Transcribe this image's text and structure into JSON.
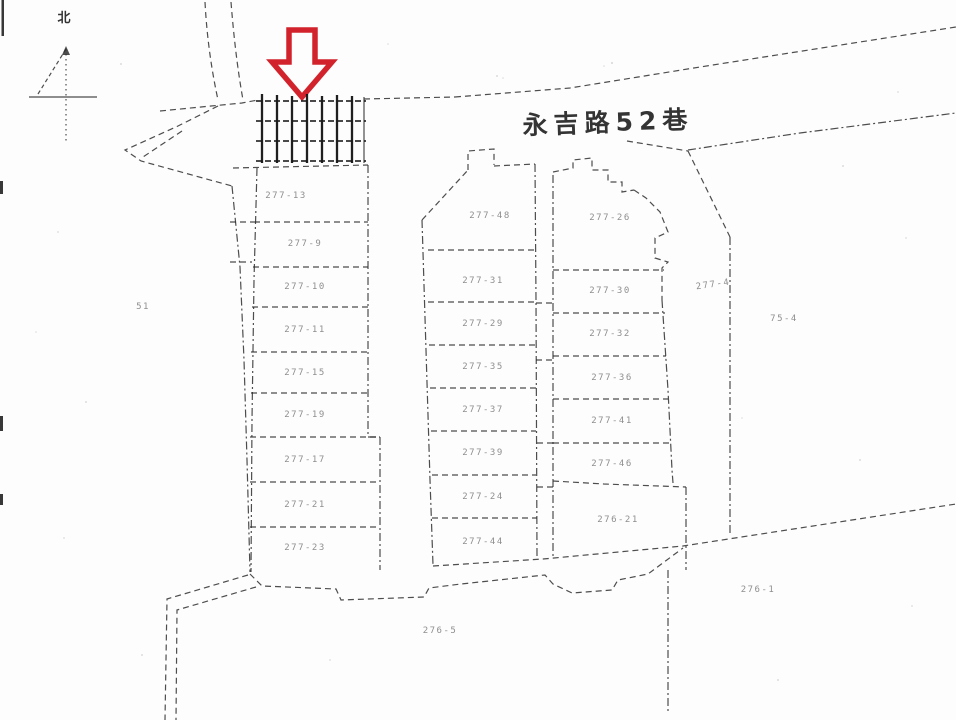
{
  "map": {
    "north_label": "北",
    "street_label": "永吉路52巷",
    "left_area_label": "51",
    "highlight_arrow_color": "#d2232c",
    "left_parcels": [
      "277-13",
      "277-9",
      "277-10",
      "277-11",
      "277-15",
      "277-19",
      "277-17",
      "277-21",
      "277-23"
    ],
    "middle_parcels": [
      "277-48",
      "277-31",
      "277-29",
      "277-35",
      "277-37",
      "277-39",
      "277-24",
      "277-44"
    ],
    "right_parcels": [
      "277-26",
      "277-30",
      "277-32",
      "277-36",
      "277-41",
      "277-46"
    ],
    "bottom_right_parcel": "276-21",
    "east_parcel": "277-4",
    "far_east_label": "75-4",
    "south_label": "276-5",
    "southeast_label": "276-1"
  }
}
